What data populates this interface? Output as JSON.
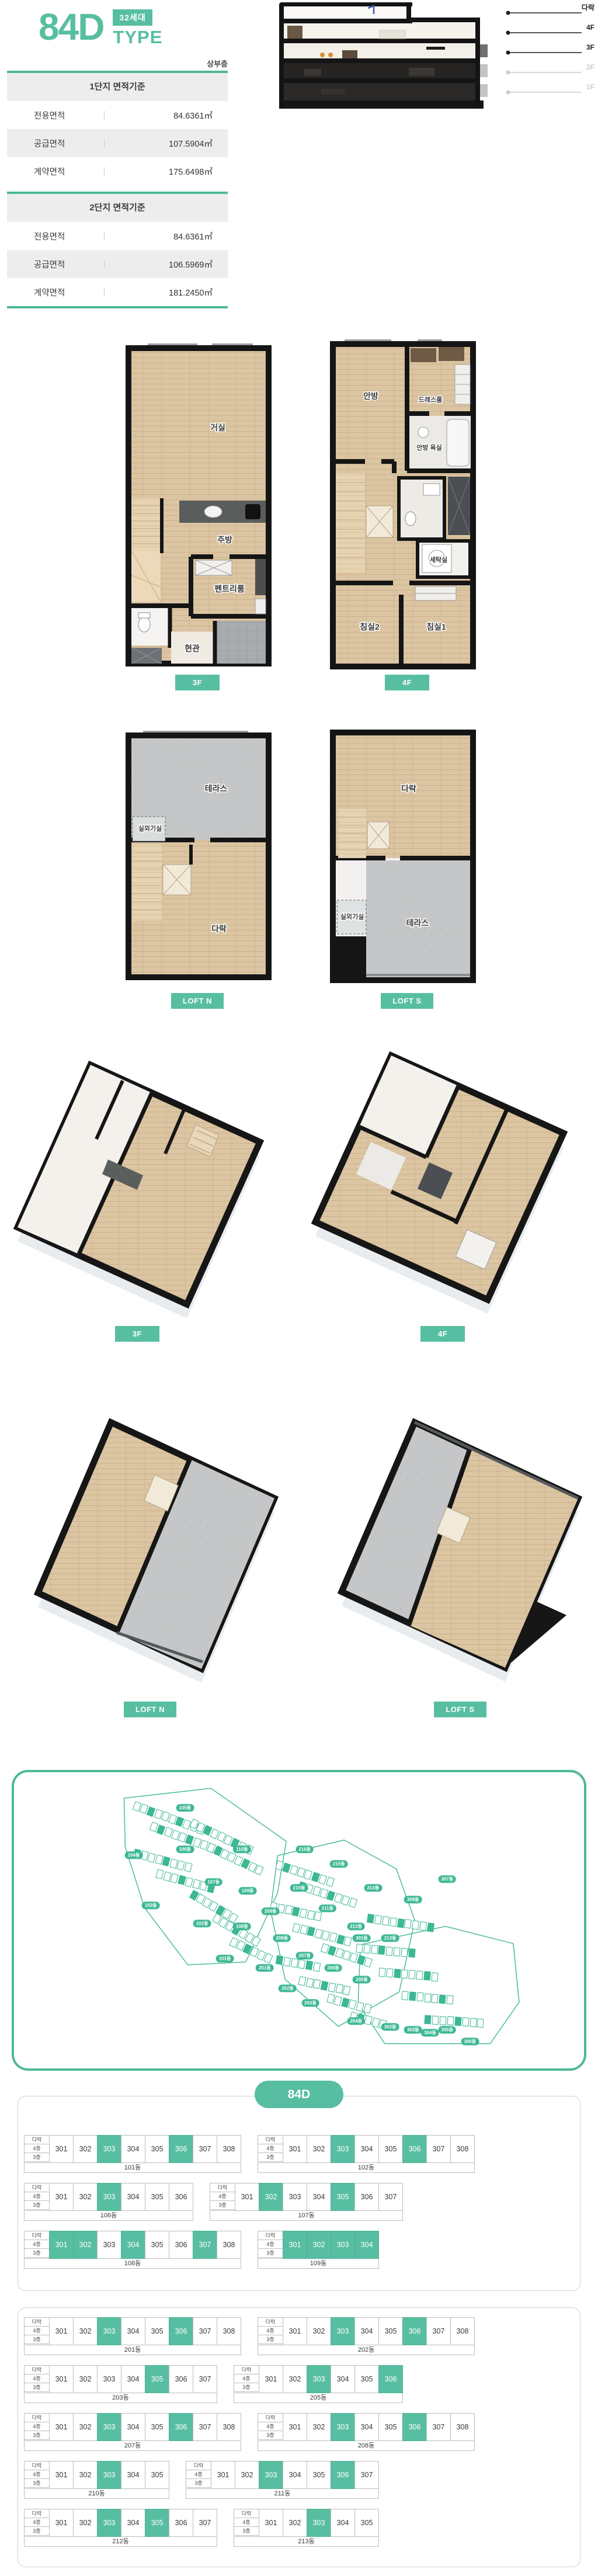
{
  "header": {
    "type_code": "84D",
    "badge": "32세대",
    "type_label": "TYPE",
    "floor_position_label": "상부층"
  },
  "area_tables": [
    {
      "title": "1단지 면적기준",
      "rows": [
        {
          "label": "전용면적",
          "value": "84.6361㎡"
        },
        {
          "label": "공급면적",
          "value": "107.5904㎡"
        },
        {
          "label": "계약면적",
          "value": "175.6498㎡"
        }
      ]
    },
    {
      "title": "2단지 면적기준",
      "rows": [
        {
          "label": "전용면적",
          "value": "84.6361㎡"
        },
        {
          "label": "공급면적",
          "value": "106.5969㎡"
        },
        {
          "label": "계약면적",
          "value": "181.2450㎡"
        }
      ]
    }
  ],
  "section_markers": {
    "floors": [
      {
        "label": "다락",
        "emph": true
      },
      {
        "label": "4F",
        "emph": true
      },
      {
        "label": "3F",
        "emph": true
      },
      {
        "label": "2F",
        "emph": false
      },
      {
        "label": "1F",
        "emph": false
      }
    ]
  },
  "plan_buttons": {
    "f3": "3F",
    "f4": "4F",
    "loft_n": "LOFT N",
    "loft_s": "LOFT S"
  },
  "plans": {
    "f3": {
      "rooms": {
        "living": "거실",
        "kitchen": "주방",
        "pantry": "펜트리룸",
        "entrance": "현관"
      }
    },
    "f4": {
      "rooms": {
        "master": "안방",
        "dress": "드레스룸",
        "master_bath": "안방 욕실",
        "laundry": "세탁실",
        "bed2": "침실2",
        "bed1": "침실1"
      }
    },
    "loft_n": {
      "rooms": {
        "terrace": "테라스",
        "ac": "실외기실",
        "attic": "다락"
      }
    },
    "loft_s": {
      "rooms": {
        "attic": "다락",
        "ac": "실외기실",
        "terrace": "테라스"
      }
    }
  },
  "site_map": {
    "labels": [
      {
        "t": "105동",
        "x": 30,
        "y": 12
      },
      {
        "t": "104동",
        "x": 21,
        "y": 28
      },
      {
        "t": "103동",
        "x": 24,
        "y": 45
      },
      {
        "t": "106동",
        "x": 30,
        "y": 26
      },
      {
        "t": "107동",
        "x": 35,
        "y": 37
      },
      {
        "t": "102동",
        "x": 33,
        "y": 51
      },
      {
        "t": "110동",
        "x": 40,
        "y": 26
      },
      {
        "t": "109동",
        "x": 41,
        "y": 40
      },
      {
        "t": "108동",
        "x": 40,
        "y": 52
      },
      {
        "t": "101동",
        "x": 37,
        "y": 63
      },
      {
        "t": "216동",
        "x": 51,
        "y": 26
      },
      {
        "t": "215동",
        "x": 57,
        "y": 31
      },
      {
        "t": "214동",
        "x": 63,
        "y": 39
      },
      {
        "t": "210동",
        "x": 50,
        "y": 39
      },
      {
        "t": "211동",
        "x": 55,
        "y": 46
      },
      {
        "t": "212동",
        "x": 60,
        "y": 52
      },
      {
        "t": "213동",
        "x": 66,
        "y": 56
      },
      {
        "t": "209동",
        "x": 45,
        "y": 47
      },
      {
        "t": "208동",
        "x": 47,
        "y": 56
      },
      {
        "t": "207동",
        "x": 51,
        "y": 62
      },
      {
        "t": "206동",
        "x": 56,
        "y": 66
      },
      {
        "t": "205동",
        "x": 61,
        "y": 70
      },
      {
        "t": "201동",
        "x": 44,
        "y": 66
      },
      {
        "t": "202동",
        "x": 48,
        "y": 73
      },
      {
        "t": "203동",
        "x": 52,
        "y": 78
      },
      {
        "t": "204동",
        "x": 60,
        "y": 84
      },
      {
        "t": "307동",
        "x": 76,
        "y": 36
      },
      {
        "t": "308동",
        "x": 70,
        "y": 43
      },
      {
        "t": "301동",
        "x": 61,
        "y": 56
      },
      {
        "t": "302동",
        "x": 66,
        "y": 86
      },
      {
        "t": "303동",
        "x": 70,
        "y": 87
      },
      {
        "t": "304동",
        "x": 73,
        "y": 88
      },
      {
        "t": "305동",
        "x": 76,
        "y": 87
      },
      {
        "t": "306동",
        "x": 80,
        "y": 91
      }
    ]
  },
  "stack_section": {
    "title": "84D",
    "row_labels": [
      "다락",
      "4층",
      "3층"
    ],
    "groups": [
      {
        "rows": [
          [
            {
              "name": "101동",
              "units": [
                "301",
                "302",
                "303",
                "304",
                "305",
                "306",
                "307",
                "308"
              ],
              "highlight": [
                "303",
                "306"
              ]
            },
            {
              "name": "102동",
              "units": [
                "301",
                "302",
                "303",
                "304",
                "305",
                "306",
                "307",
                "308"
              ],
              "highlight": [
                "303",
                "306"
              ]
            }
          ],
          [
            {
              "name": "106동",
              "units": [
                "301",
                "302",
                "303",
                "304",
                "305",
                "306"
              ],
              "highlight": [
                "303"
              ]
            },
            {
              "name": "107동",
              "units": [
                "301",
                "302",
                "303",
                "304",
                "305",
                "306",
                "307"
              ],
              "highlight": [
                "302",
                "305"
              ]
            }
          ],
          [
            {
              "name": "108동",
              "units": [
                "301",
                "302",
                "303",
                "304",
                "305",
                "306",
                "307",
                "308"
              ],
              "highlight": [
                "301",
                "302",
                "304",
                "307"
              ]
            },
            {
              "name": "109동",
              "units": [
                "301",
                "302",
                "303",
                "304"
              ],
              "highlight": [
                "301",
                "302",
                "303",
                "304"
              ]
            }
          ]
        ]
      },
      {
        "rows": [
          [
            {
              "name": "201동",
              "units": [
                "301",
                "302",
                "303",
                "304",
                "305",
                "306",
                "307",
                "308"
              ],
              "highlight": [
                "303",
                "306"
              ]
            },
            {
              "name": "202동",
              "units": [
                "301",
                "302",
                "303",
                "304",
                "305",
                "306",
                "307",
                "308"
              ],
              "highlight": [
                "303",
                "306"
              ]
            }
          ],
          [
            {
              "name": "203동",
              "units": [
                "301",
                "302",
                "303",
                "304",
                "305",
                "306",
                "307"
              ],
              "highlight": [
                "305"
              ]
            },
            {
              "name": "205동",
              "units": [
                "301",
                "302",
                "303",
                "304",
                "305",
                "306"
              ],
              "highlight": [
                "303",
                "306"
              ]
            }
          ],
          [
            {
              "name": "207동",
              "units": [
                "301",
                "302",
                "303",
                "304",
                "305",
                "306",
                "307",
                "308"
              ],
              "highlight": [
                "303",
                "306"
              ]
            },
            {
              "name": "208동",
              "units": [
                "301",
                "302",
                "303",
                "304",
                "305",
                "306",
                "307",
                "308"
              ],
              "highlight": [
                "303",
                "306"
              ]
            }
          ],
          [
            {
              "name": "210동",
              "units": [
                "301",
                "302",
                "303",
                "304",
                "305"
              ],
              "highlight": [
                "303"
              ]
            },
            {
              "name": "211동",
              "units": [
                "301",
                "302",
                "303",
                "304",
                "305",
                "306",
                "307"
              ],
              "highlight": [
                "303",
                "306"
              ]
            }
          ],
          [
            {
              "name": "212동",
              "units": [
                "301",
                "302",
                "303",
                "304",
                "305",
                "306",
                "307"
              ],
              "highlight": [
                "303",
                "305"
              ]
            },
            {
              "name": "213동",
              "units": [
                "301",
                "302",
                "303",
                "304",
                "305"
              ],
              "highlight": [
                "303"
              ]
            }
          ]
        ]
      }
    ]
  }
}
